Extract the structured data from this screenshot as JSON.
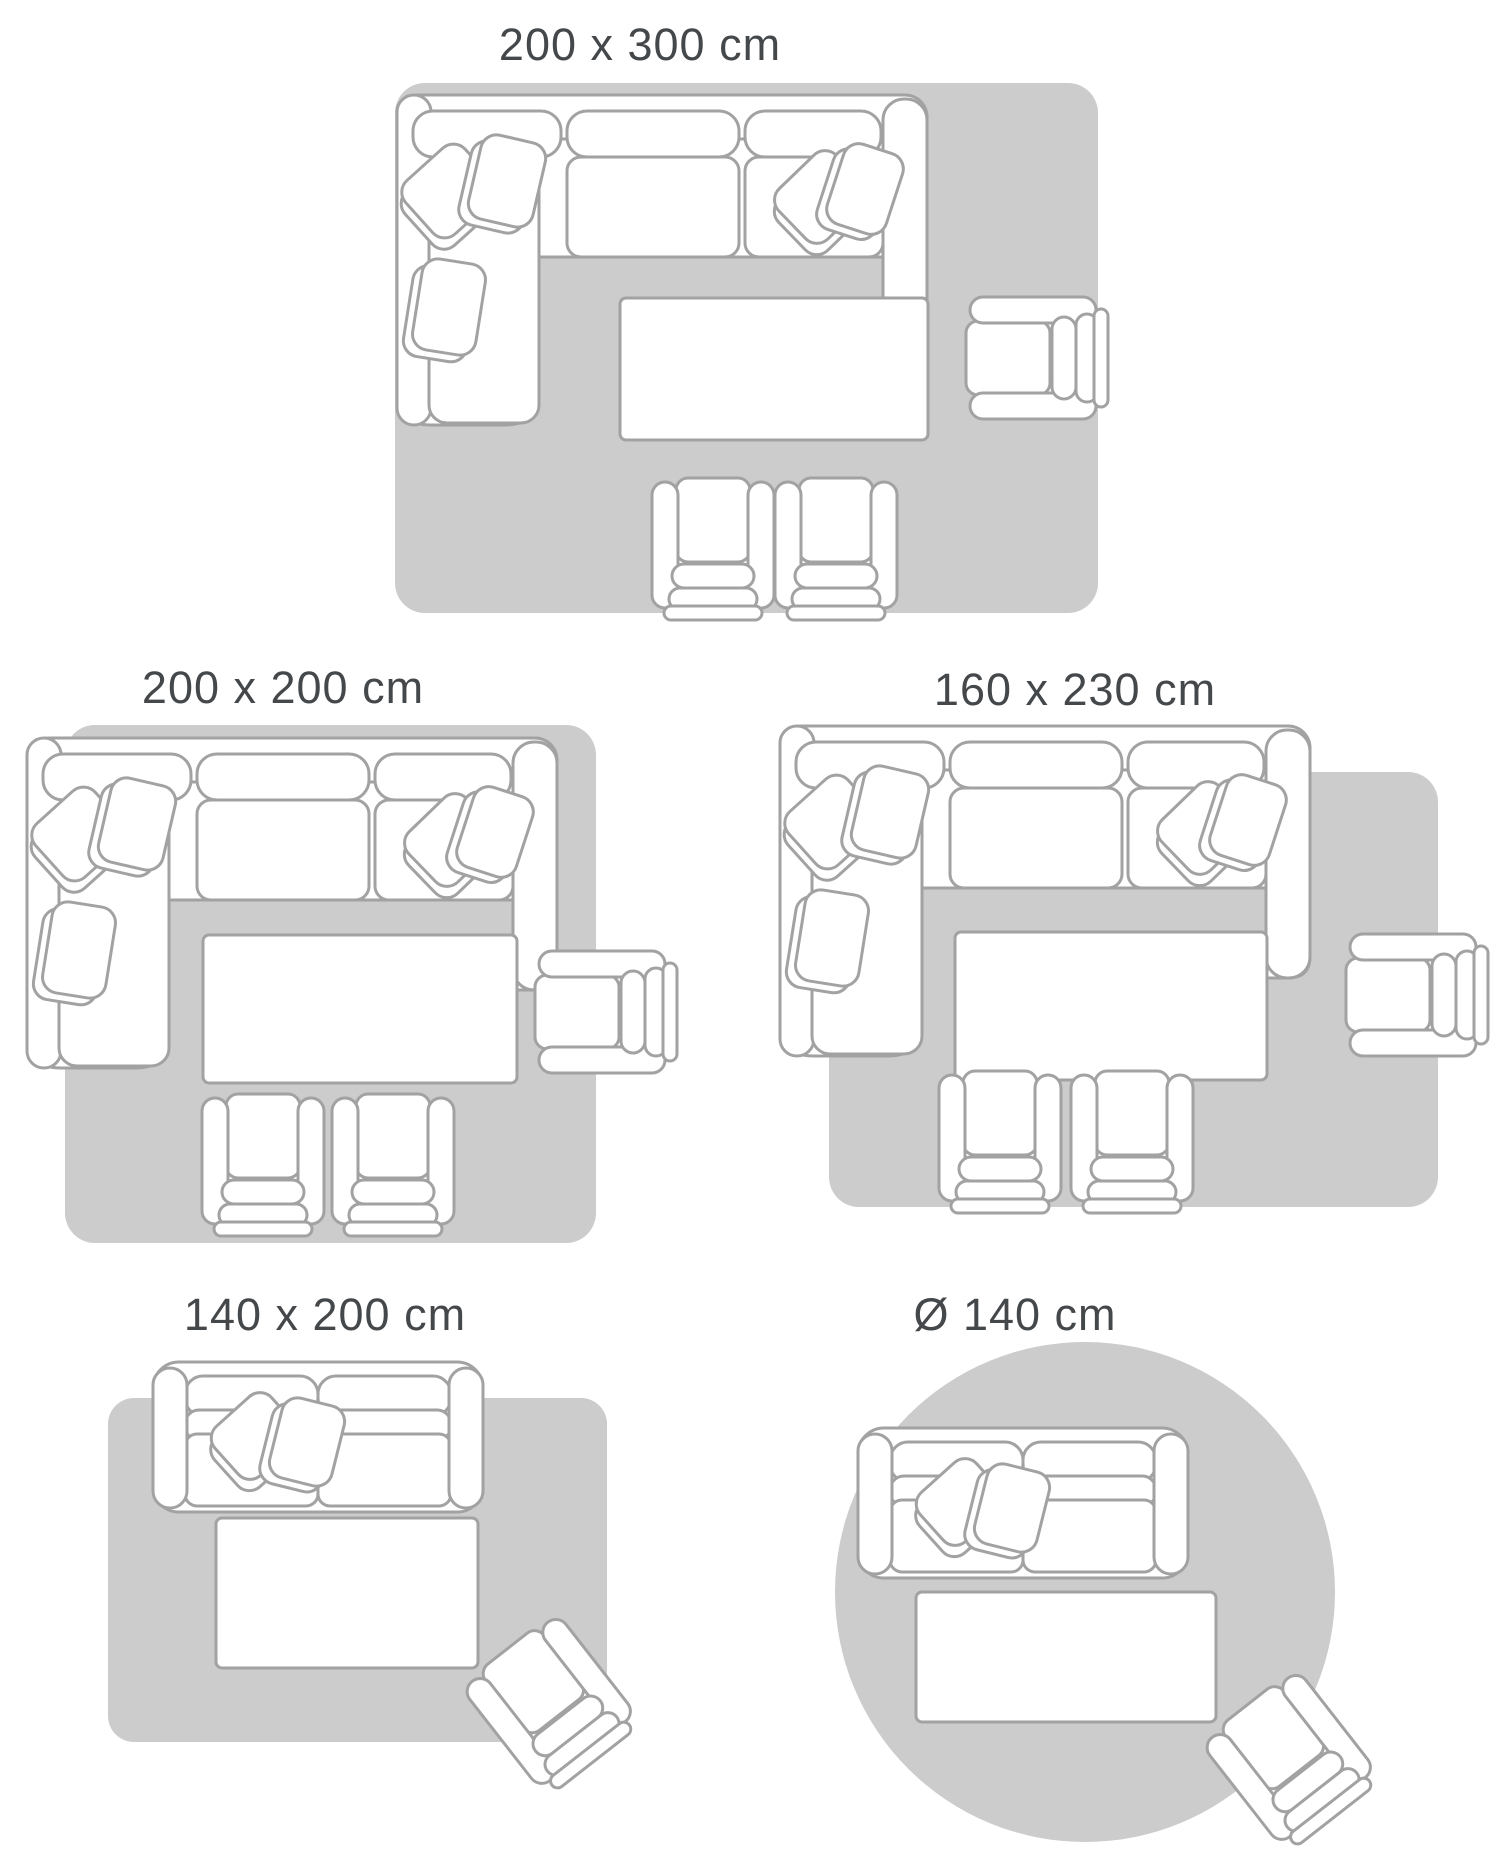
{
  "page": {
    "background": "#ffffff",
    "kind": "rug-size-guide"
  },
  "colors": {
    "rug": "#cccccc",
    "line": "#a2a2a2",
    "fill": "#ffffff",
    "text": "#45484b",
    "bg": "#ffffff"
  },
  "panels": [
    {
      "label": "200 x 300 cm",
      "rug_shape": "rectangle",
      "furniture": [
        "corner-sofa",
        "coffee-table",
        "side-armchair",
        "armchair",
        "armchair"
      ]
    },
    {
      "label": "200 x 200 cm",
      "rug_shape": "rectangle",
      "furniture": [
        "corner-sofa",
        "coffee-table",
        "side-armchair",
        "armchair",
        "armchair"
      ]
    },
    {
      "label": "160 x 230 cm",
      "rug_shape": "rectangle",
      "furniture": [
        "corner-sofa",
        "coffee-table",
        "side-armchair",
        "armchair",
        "armchair"
      ]
    },
    {
      "label": "140 x 200 cm",
      "rug_shape": "rectangle",
      "furniture": [
        "loveseat-sofa",
        "coffee-table",
        "armchair"
      ]
    },
    {
      "label": "Ø 140 cm",
      "rug_shape": "circle",
      "furniture": [
        "loveseat-sofa",
        "coffee-table",
        "armchair"
      ]
    }
  ]
}
